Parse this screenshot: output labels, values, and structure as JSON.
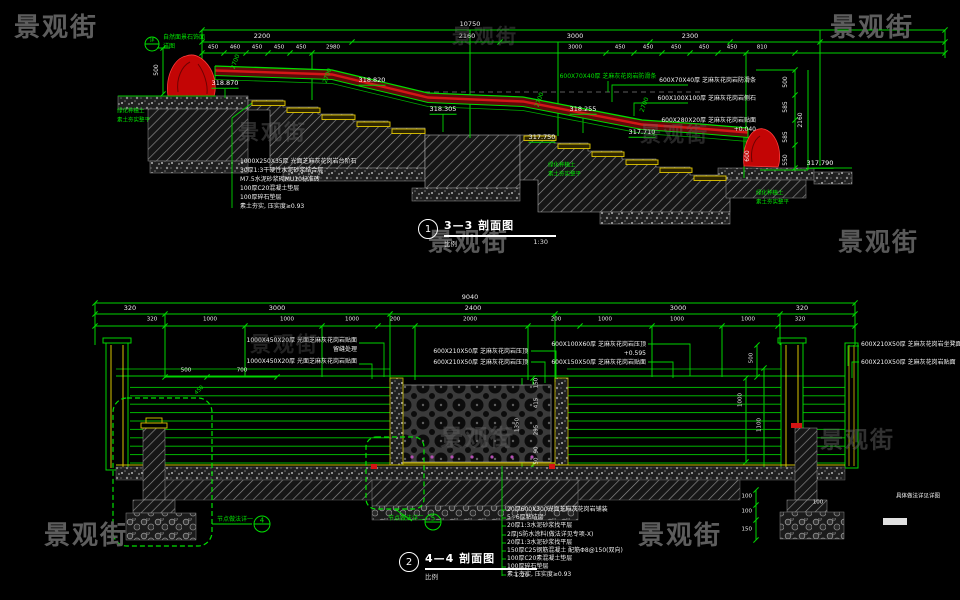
{
  "app": {
    "background": "#000000",
    "line_green": "#00d400",
    "dim_text_color": "#ededed",
    "band_red": "#5f0909",
    "rock_red": "#c30505",
    "tread_yellow": "#e3c800",
    "watermark_color": "#636363"
  },
  "watermark_text": "景观街",
  "watermarks": [
    {
      "x": 14,
      "y": 28,
      "s": 26,
      "o": 0.95,
      "c": "wm",
      "a": "l"
    },
    {
      "x": 452,
      "y": 36,
      "s": 20,
      "o": 0.4,
      "c": "wm",
      "a": "l"
    },
    {
      "x": 830,
      "y": 28,
      "s": 26,
      "o": 0.95,
      "c": "wm",
      "a": "l"
    },
    {
      "x": 238,
      "y": 132,
      "s": 21,
      "o": 0.45,
      "c": "wm",
      "a": "l"
    },
    {
      "x": 640,
      "y": 134,
      "s": 21,
      "o": 0.4,
      "c": "wm",
      "a": "l"
    },
    {
      "x": 428,
      "y": 242,
      "s": 25,
      "o": 0.9,
      "c": "wm",
      "a": "l"
    },
    {
      "x": 838,
      "y": 242,
      "s": 25,
      "o": 0.9,
      "c": "wm",
      "a": "l"
    },
    {
      "x": 250,
      "y": 344,
      "s": 21,
      "o": 0.35,
      "c": "wm",
      "a": "l"
    },
    {
      "x": 440,
      "y": 438,
      "s": 23,
      "o": 0.45,
      "c": "wm",
      "a": "l"
    },
    {
      "x": 820,
      "y": 440,
      "s": 23,
      "o": 0.5,
      "c": "wm",
      "a": "l"
    },
    {
      "x": 44,
      "y": 536,
      "s": 26,
      "o": 0.95,
      "c": "wm",
      "a": "l"
    },
    {
      "x": 638,
      "y": 536,
      "s": 26,
      "o": 0.95,
      "c": "wm",
      "a": "l"
    }
  ],
  "top_drawing": {
    "title": {
      "number": "1",
      "name": "3—3 剖面图",
      "scale_label": "比例",
      "scale_value": "1:30"
    },
    "labels": [
      {
        "t": "10750",
        "x": 470,
        "y": 24
      },
      {
        "t": "2200",
        "x": 262,
        "y": 36
      },
      {
        "t": "2160",
        "x": 467,
        "y": 36
      },
      {
        "t": "3000",
        "x": 575,
        "y": 36
      },
      {
        "t": "2300",
        "x": 690,
        "y": 36
      },
      {
        "t": "450",
        "x": 213,
        "y": 48,
        "s": 5.5
      },
      {
        "t": "460",
        "x": 235,
        "y": 48,
        "s": 5.5
      },
      {
        "t": "450",
        "x": 257,
        "y": 48,
        "s": 5.5
      },
      {
        "t": "450",
        "x": 279,
        "y": 48,
        "s": 5.5
      },
      {
        "t": "450",
        "x": 301,
        "y": 48,
        "s": 5.5
      },
      {
        "t": "2980",
        "x": 333,
        "y": 48,
        "s": 5.5
      },
      {
        "t": "3000",
        "x": 575,
        "y": 48,
        "s": 5.5
      },
      {
        "t": "450",
        "x": 620,
        "y": 48,
        "s": 5.5
      },
      {
        "t": "450",
        "x": 648,
        "y": 48,
        "s": 5.5
      },
      {
        "t": "450",
        "x": 676,
        "y": 48,
        "s": 5.5
      },
      {
        "t": "450",
        "x": 704,
        "y": 48,
        "s": 5.5
      },
      {
        "t": "450",
        "x": 732,
        "y": 48,
        "s": 5.5
      },
      {
        "t": "810",
        "x": 762,
        "y": 48,
        "s": 5.5
      },
      {
        "t": "500",
        "x": 786,
        "y": 82,
        "r": -90,
        "s": 6
      },
      {
        "t": "585",
        "x": 786,
        "y": 107,
        "r": -90,
        "s": 6
      },
      {
        "t": "585",
        "x": 786,
        "y": 137,
        "r": -90,
        "s": 6
      },
      {
        "t": "550",
        "x": 786,
        "y": 160,
        "r": -90,
        "s": 6
      },
      {
        "t": "2160",
        "x": 801,
        "y": 120,
        "r": -90,
        "s": 6
      },
      {
        "t": "2700",
        "x": 236,
        "y": 62,
        "r": -70,
        "s": 6,
        "c": "grn"
      },
      {
        "t": "2700",
        "x": 328,
        "y": 76,
        "r": -70,
        "s": 6,
        "c": "grn"
      },
      {
        "t": "2700",
        "x": 540,
        "y": 100,
        "r": -70,
        "s": 6,
        "c": "grn"
      },
      {
        "t": "2700",
        "x": 645,
        "y": 105,
        "r": -70,
        "s": 6,
        "c": "grn"
      },
      {
        "t": "500",
        "x": 157,
        "y": 70,
        "r": -90,
        "s": 6
      },
      {
        "t": "600",
        "x": 748,
        "y": 156,
        "r": -90,
        "s": 6
      },
      {
        "t": "318.870",
        "x": 225,
        "y": 84,
        "c": "elev",
        "s": 6.5
      },
      {
        "t": "318.820",
        "x": 372,
        "y": 81,
        "c": "elev",
        "s": 6.5
      },
      {
        "t": "318.305",
        "x": 443,
        "y": 110,
        "c": "elev",
        "s": 6.5
      },
      {
        "t": "318.255",
        "x": 583,
        "y": 110,
        "c": "elev",
        "s": 6.5
      },
      {
        "t": "317.750",
        "x": 542,
        "y": 138,
        "c": "elev",
        "s": 6.5
      },
      {
        "t": "317.710",
        "x": 642,
        "y": 133,
        "c": "elev",
        "s": 6.5
      },
      {
        "t": "317.790",
        "x": 820,
        "y": 164,
        "c": "elev",
        "s": 6.5
      },
      {
        "t": "600X70X40厚 芝麻灰花岗岩防滑条",
        "x": 756,
        "y": 81,
        "a": "r",
        "s": 6,
        "c": "ann"
      },
      {
        "t": "600X100X100厚 芝麻灰花岗岩侧石",
        "x": 756,
        "y": 99,
        "a": "r",
        "s": 6,
        "c": "ann"
      },
      {
        "t": "600X280X20厚 芝麻灰花岗岩贴面",
        "x": 756,
        "y": 121,
        "a": "r",
        "s": 6,
        "c": "ann"
      },
      {
        "t": "+0.040",
        "x": 756,
        "y": 130,
        "a": "r",
        "s": 6,
        "c": "ann"
      },
      {
        "t": "600X70X40厚 芝麻灰花岗岩防滑条",
        "x": 608,
        "y": 77,
        "s": 6,
        "c": "grn"
      },
      {
        "t": "1000X250X35厚 光面芝麻灰花岗岩台阶石",
        "x": 240,
        "y": 162,
        "a": "l",
        "s": 6,
        "c": "ann"
      },
      {
        "t": "30厚1:3干硬性水泥砂浆结合层",
        "x": 240,
        "y": 171,
        "a": "l",
        "s": 6,
        "c": "ann"
      },
      {
        "t": "M7.5水泥砂浆砌MU10标准砖",
        "x": 240,
        "y": 180,
        "a": "l",
        "s": 6,
        "c": "ann"
      },
      {
        "t": "100厚C20混凝土垫层",
        "x": 240,
        "y": 189,
        "a": "l",
        "s": 6,
        "c": "ann"
      },
      {
        "t": "100厚碎石垫层",
        "x": 240,
        "y": 198,
        "a": "l",
        "s": 6,
        "c": "ann"
      },
      {
        "t": "素土夯实, 压实度≥0.93",
        "x": 240,
        "y": 207,
        "a": "l",
        "s": 6,
        "c": "ann"
      },
      {
        "t": "绿化种植土",
        "x": 117,
        "y": 112,
        "a": "l",
        "s": 5.5,
        "c": "grn"
      },
      {
        "t": "素土夯实整平",
        "x": 117,
        "y": 121,
        "a": "l",
        "s": 5.5,
        "c": "grn"
      },
      {
        "t": "绿化种植土",
        "x": 548,
        "y": 166,
        "a": "l",
        "s": 5.5,
        "c": "grn"
      },
      {
        "t": "素土夯实整平",
        "x": 548,
        "y": 175,
        "a": "l",
        "s": 5.5,
        "c": "grn"
      },
      {
        "t": "绿化种植土",
        "x": 756,
        "y": 194,
        "a": "l",
        "s": 5.5,
        "c": "grn"
      },
      {
        "t": "素土夯实整平",
        "x": 756,
        "y": 203,
        "a": "l",
        "s": 5.5,
        "c": "grn"
      },
      {
        "t": "自然面景石饰面",
        "x": 163,
        "y": 38,
        "a": "l",
        "s": 6,
        "c": "grn"
      },
      {
        "t": "详图",
        "x": 163,
        "y": 47,
        "a": "l",
        "s": 6,
        "c": "grn"
      },
      {
        "t": "详",
        "x": 152,
        "y": 41,
        "s": 5,
        "c": "grn"
      }
    ]
  },
  "bottom_drawing": {
    "title": {
      "number": "2",
      "name": "4—4 剖面图",
      "scale_label": "比例",
      "scale_value": "1:20"
    },
    "labels": [
      {
        "t": "9040",
        "x": 470,
        "y": 297
      },
      {
        "t": "320",
        "x": 130,
        "y": 308
      },
      {
        "t": "3000",
        "x": 277,
        "y": 308
      },
      {
        "t": "2400",
        "x": 473,
        "y": 308
      },
      {
        "t": "3000",
        "x": 678,
        "y": 308
      },
      {
        "t": "320",
        "x": 802,
        "y": 308
      },
      {
        "t": "320",
        "x": 152,
        "y": 320,
        "s": 5.5
      },
      {
        "t": "1000",
        "x": 210,
        "y": 320,
        "s": 5.5
      },
      {
        "t": "1000",
        "x": 287,
        "y": 320,
        "s": 5.5
      },
      {
        "t": "1000",
        "x": 352,
        "y": 320,
        "s": 5.5
      },
      {
        "t": "200",
        "x": 395,
        "y": 320,
        "s": 5.5
      },
      {
        "t": "2000",
        "x": 470,
        "y": 320,
        "s": 5.5
      },
      {
        "t": "200",
        "x": 556,
        "y": 320,
        "s": 5.5
      },
      {
        "t": "1000",
        "x": 605,
        "y": 320,
        "s": 5.5
      },
      {
        "t": "1000",
        "x": 677,
        "y": 320,
        "s": 5.5
      },
      {
        "t": "1000",
        "x": 748,
        "y": 320,
        "s": 5.5
      },
      {
        "t": "320",
        "x": 800,
        "y": 320,
        "s": 5.5
      },
      {
        "t": "500",
        "x": 186,
        "y": 371,
        "s": 5.5
      },
      {
        "t": "700",
        "x": 242,
        "y": 371,
        "s": 5.5
      },
      {
        "t": "450",
        "x": 200,
        "y": 391,
        "r": -45,
        "s": 5.5,
        "c": "grn"
      },
      {
        "t": "150",
        "x": 537,
        "y": 383,
        "r": -90,
        "s": 5.5
      },
      {
        "t": "415",
        "x": 537,
        "y": 403,
        "r": -90,
        "s": 5.5
      },
      {
        "t": "295",
        "x": 537,
        "y": 430,
        "r": -90,
        "s": 5.5
      },
      {
        "t": "90",
        "x": 537,
        "y": 450,
        "r": -90,
        "s": 5.5
      },
      {
        "t": "50",
        "x": 537,
        "y": 461,
        "r": -90,
        "s": 5.5
      },
      {
        "t": "1350",
        "x": 518,
        "y": 425,
        "r": -90,
        "s": 5.5
      },
      {
        "t": "500",
        "x": 752,
        "y": 358,
        "r": -90,
        "s": 5.5
      },
      {
        "t": "1000",
        "x": 741,
        "y": 400,
        "r": -90,
        "s": 5.5
      },
      {
        "t": "1100",
        "x": 760,
        "y": 425,
        "r": -90,
        "s": 5.5
      },
      {
        "t": "100",
        "x": 752,
        "y": 497,
        "a": "r",
        "s": 5.5
      },
      {
        "t": "100",
        "x": 752,
        "y": 512,
        "a": "r",
        "s": 5.5
      },
      {
        "t": "150",
        "x": 752,
        "y": 530,
        "a": "r",
        "s": 5.5
      },
      {
        "t": "100",
        "x": 818,
        "y": 503,
        "s": 5.5
      },
      {
        "t": "1000X450X20厚 光面芝麻灰花岗岩贴面",
        "x": 357,
        "y": 341,
        "a": "r",
        "s": 6,
        "c": "ann"
      },
      {
        "t": "留缝处理",
        "x": 357,
        "y": 350,
        "a": "r",
        "s": 6,
        "c": "ann"
      },
      {
        "t": "1000X450X20厚 光面芝麻灰花岗岩贴面",
        "x": 357,
        "y": 362,
        "a": "r",
        "s": 6,
        "c": "ann"
      },
      {
        "t": "600X210X50厚 芝麻灰花岗岩压顶",
        "x": 528,
        "y": 352,
        "a": "r",
        "s": 6,
        "c": "ann"
      },
      {
        "t": "600X210X50厚 芝麻灰花岗岩压顶",
        "x": 528,
        "y": 363,
        "a": "r",
        "s": 6,
        "c": "ann"
      },
      {
        "t": "600X100X60厚 芝麻灰花岗岩压顶",
        "x": 646,
        "y": 345,
        "a": "r",
        "s": 6,
        "c": "ann"
      },
      {
        "t": "+0.595",
        "x": 646,
        "y": 354,
        "a": "r",
        "s": 6,
        "c": "ann"
      },
      {
        "t": "600X150X50厚 芝麻灰花岗岩贴面",
        "x": 646,
        "y": 363,
        "a": "r",
        "s": 6,
        "c": "ann"
      },
      {
        "t": "600X210X50厚 芝麻灰花岗岩坐凳面",
        "x": 861,
        "y": 345,
        "a": "l",
        "s": 6,
        "c": "ann"
      },
      {
        "t": "600X210X50厚 芝麻灰花岗岩贴面",
        "x": 861,
        "y": 363,
        "a": "l",
        "s": 6,
        "c": "ann"
      },
      {
        "t": "20厚600X300光面芝麻灰花岗岩铺装",
        "x": 507,
        "y": 510,
        "a": "l",
        "s": 6,
        "c": "note"
      },
      {
        "t": "5~6厚粘结层",
        "x": 507,
        "y": 518,
        "a": "l",
        "s": 6,
        "c": "note"
      },
      {
        "t": "20厚1:3水泥砂浆找平层",
        "x": 507,
        "y": 526,
        "a": "l",
        "s": 6,
        "c": "note"
      },
      {
        "t": "2厚JS防水涂料(做法详见专项-X)",
        "x": 507,
        "y": 535,
        "a": "l",
        "s": 6,
        "c": "note"
      },
      {
        "t": "20厚1:3水泥砂浆找平层",
        "x": 507,
        "y": 543,
        "a": "l",
        "s": 6,
        "c": "note"
      },
      {
        "t": "150厚C25钢筋混凝土 配筋Φ8@150(双向)",
        "x": 507,
        "y": 551,
        "a": "l",
        "s": 6,
        "c": "note"
      },
      {
        "t": "100厚C20素混凝土垫层",
        "x": 507,
        "y": 559,
        "a": "l",
        "s": 6,
        "c": "note"
      },
      {
        "t": "100厚碎石垫层",
        "x": 507,
        "y": 567,
        "a": "l",
        "s": 6,
        "c": "note"
      },
      {
        "t": "素土夯实, 压实度≥0.93",
        "x": 507,
        "y": 575,
        "a": "l",
        "s": 6,
        "c": "note"
      },
      {
        "t": "节点做法详一",
        "x": 253,
        "y": 520,
        "a": "r",
        "s": 6,
        "c": "grn"
      },
      {
        "t": "4",
        "x": 262,
        "y": 521,
        "s": 7,
        "c": "grn"
      },
      {
        "t": "节点做法详二",
        "x": 424,
        "y": 519,
        "a": "r",
        "s": 6,
        "c": "grn"
      },
      {
        "t": "5",
        "x": 433,
        "y": 519,
        "s": 7,
        "c": "grn"
      },
      {
        "t": "具体做法详见详图",
        "x": 896,
        "y": 497,
        "a": "l",
        "s": 5.5,
        "c": "ann"
      }
    ]
  }
}
